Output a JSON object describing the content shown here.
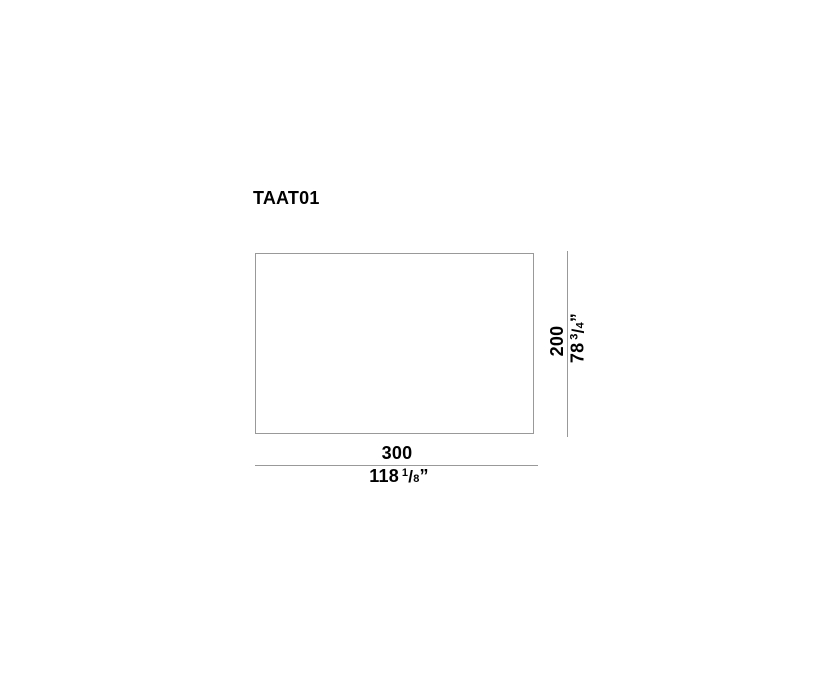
{
  "title": "TAAT01",
  "colors": {
    "background": "#ffffff",
    "line": "#999999",
    "text": "#000000"
  },
  "drawing": {
    "shape": "rectangle-top-view",
    "dimensions": {
      "width": {
        "cm": "300",
        "in_whole": "118",
        "in_num": "1",
        "in_slash": "/",
        "in_den": "8",
        "in_unit": "”"
      },
      "height": {
        "cm": "200",
        "in_whole": "78",
        "in_num": "3",
        "in_slash": "/",
        "in_den": "4",
        "in_unit": "”"
      }
    }
  }
}
